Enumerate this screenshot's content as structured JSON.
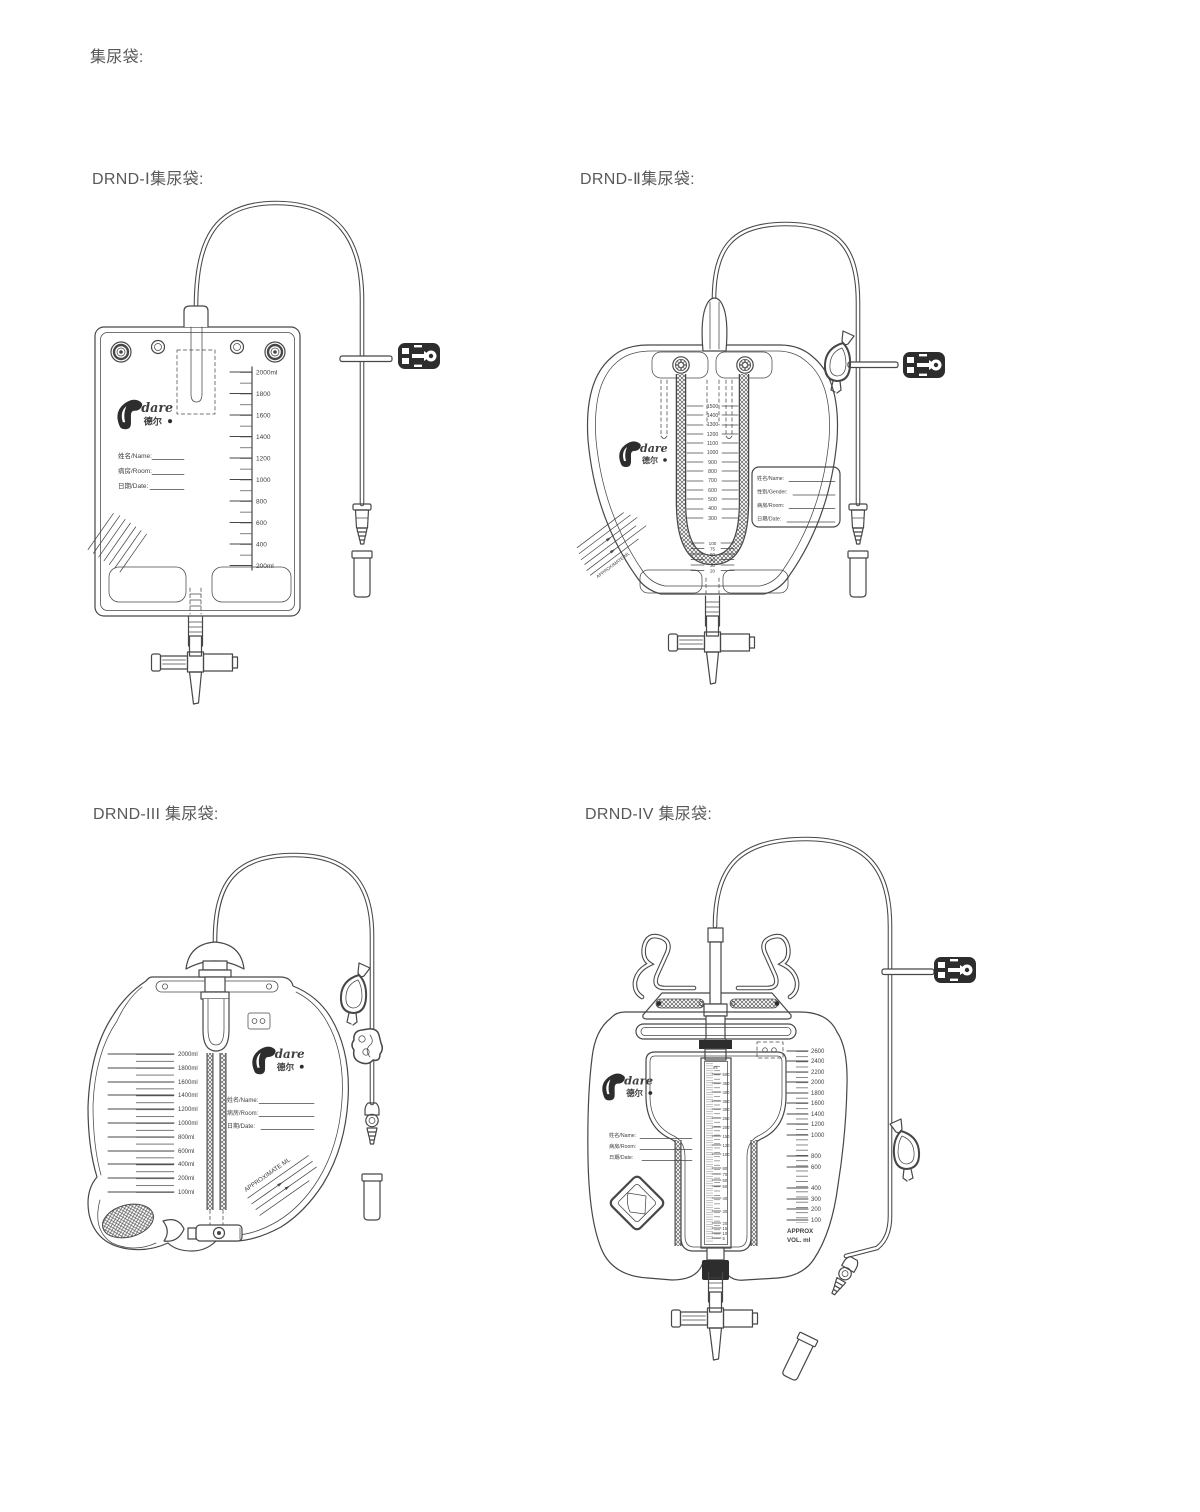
{
  "page": {
    "title": "集尿袋:"
  },
  "brand": {
    "latin": "dare",
    "cjk": "德尔"
  },
  "drnd1": {
    "label": "DRND-Ⅰ集尿袋:",
    "fields": {
      "name": "姓名/Name:",
      "room": "病房/Room:",
      "date": "日期/Date:"
    },
    "scale": [
      "2000ml",
      "1800",
      "1600",
      "1400",
      "1200",
      "1000",
      "800",
      "600",
      "400",
      "200ml"
    ]
  },
  "drnd2": {
    "label": "DRND-Ⅱ集尿袋:",
    "fields": {
      "name": "姓名/Name:",
      "gender": "性别/Gender:",
      "room": "病房/Room:",
      "date": "日期/Date:"
    },
    "scale_main": [
      "1500",
      "1400",
      "1300",
      "1200",
      "1100",
      "1000",
      "900",
      "800",
      "700",
      "600",
      "500",
      "400",
      "300"
    ],
    "scale_small": [
      "100",
      "75",
      "50",
      "40",
      "30",
      "20"
    ],
    "approx": "APPROXIMATE ML"
  },
  "drnd3": {
    "label": "DRND-III 集尿袋:",
    "fields": {
      "name": "姓名/Name:",
      "room": "病房/Room:",
      "date": "日期/Date:"
    },
    "scale": [
      "2000ml",
      "1800ml",
      "1600ml",
      "1400ml",
      "1200ml",
      "1000ml",
      "800ml",
      "600ml",
      "400ml",
      "200ml",
      "100ml"
    ],
    "approx": "APPROXIMATE ML"
  },
  "drnd4": {
    "label": "DRND-IV 集尿袋:",
    "fields": {
      "name": "姓名/Name:",
      "room": "病房/Room:",
      "date": "日期/Date:"
    },
    "scale_right": [
      "2600",
      "2400",
      "2200",
      "2000",
      "1800",
      "1600",
      "1400",
      "1200",
      "1000",
      "800",
      "600",
      "400",
      "300",
      "200",
      "100"
    ],
    "approx1": "APPROX",
    "approx2": "VOL. ml",
    "meter_unit": "ml",
    "meter": [
      "500",
      "450",
      "400",
      "350",
      "300",
      "250",
      "200",
      "150",
      "120",
      "100",
      "80",
      "70",
      "60",
      "50",
      "40",
      "30",
      "20",
      "15",
      "10",
      "5"
    ]
  }
}
